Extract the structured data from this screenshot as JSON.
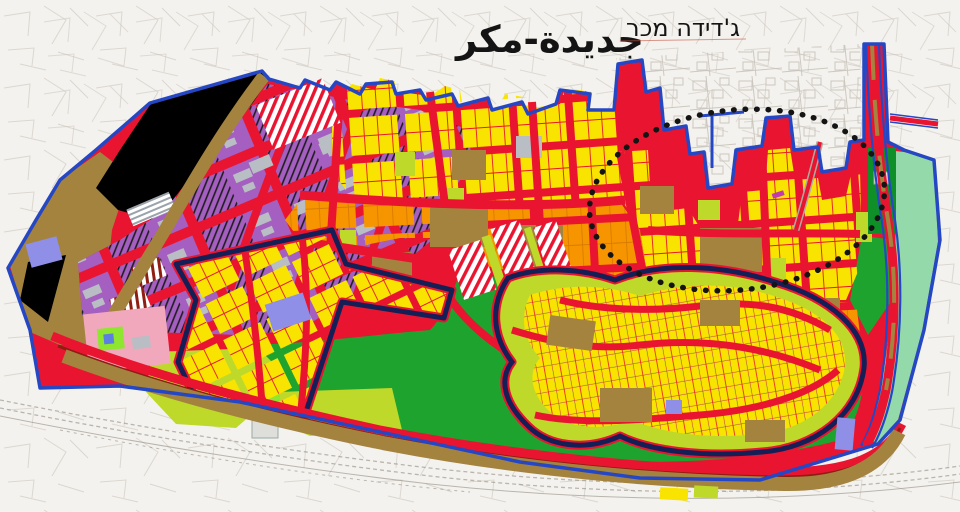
{
  "title": {
    "arabic": "جديدة-مكر",
    "hebrew": "ג'דידה מכר"
  },
  "palette": {
    "background": "#f4f2ee",
    "sketch": "#c6c1b7",
    "rail": "#938d82",
    "boundary_blue": "#2547c4",
    "road_red": "#e91530",
    "dark_red": "#8e1d12",
    "navy": "#161f55",
    "yellow": "#f8e400",
    "orange": "#f79500",
    "orange_line": "#d97b00",
    "chartreuse": "#bfd92a",
    "bright_green": "#8ee62e",
    "green": "#1ea32e",
    "dark_green": "#0e8f28",
    "mint": "#93d9a9",
    "brown": "#a4833f",
    "purple": "#a55fc0",
    "lavender": "#8f8fe8",
    "pink": "#f2a8bc",
    "magenta": "#c03ab0",
    "gray_building": "#b9bdc4",
    "black": "#141414",
    "white": "#ffffff"
  }
}
